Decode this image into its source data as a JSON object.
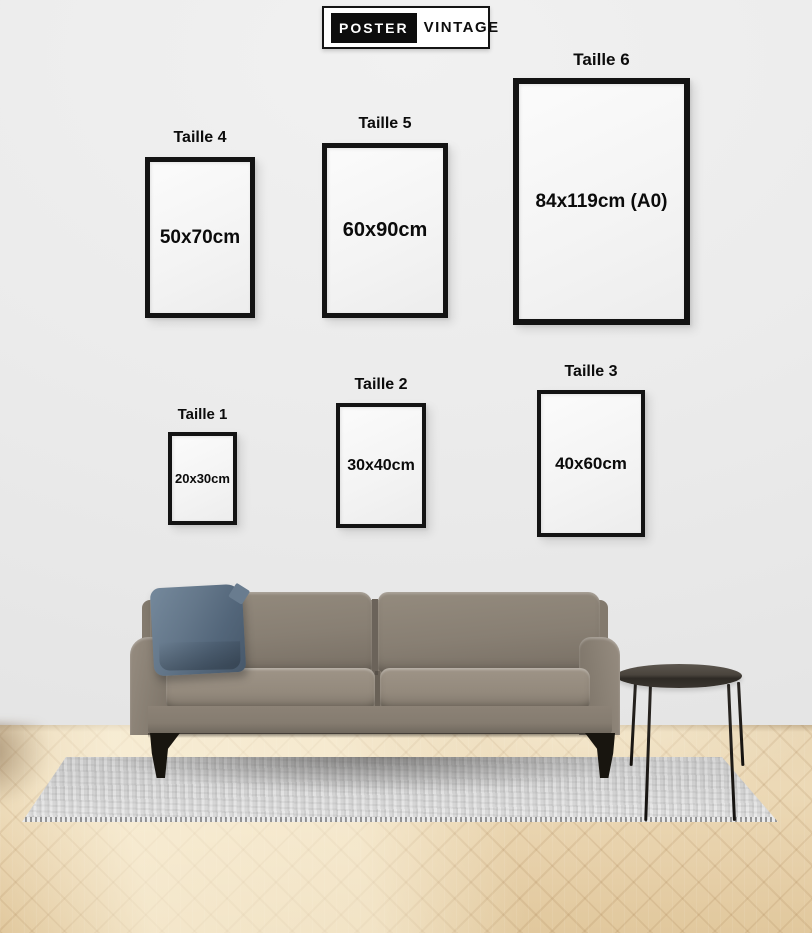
{
  "brand": {
    "name_left": "POSTER",
    "name_right": "VINTAGE"
  },
  "size_guide": {
    "frames": {
      "taille1": {
        "label": "Taille 1",
        "size": "20x30cm"
      },
      "taille2": {
        "label": "Taille 2",
        "size": "30x40cm"
      },
      "taille3": {
        "label": "Taille 3",
        "size": "40x60cm"
      },
      "taille4": {
        "label": "Taille 4",
        "size": "50x70cm"
      },
      "taille5": {
        "label": "Taille 5",
        "size": "60x90cm"
      },
      "taille6": {
        "label": "Taille 6",
        "size": "84x119cm (A0)"
      }
    }
  },
  "scene": {
    "colors": {
      "wall": "#ececec",
      "frame_border": "#131313",
      "frame_fill": "#f4f4f4",
      "floor_wood_light": "#f2e4c8",
      "floor_wood_mid": "#e7d2ad",
      "rug_gray": "#d6d6d6",
      "sofa_taupe": "#8b8174",
      "pillow_blue": "#5c6f82",
      "table_dark": "#3c3731",
      "leg_black": "#18150f"
    }
  }
}
